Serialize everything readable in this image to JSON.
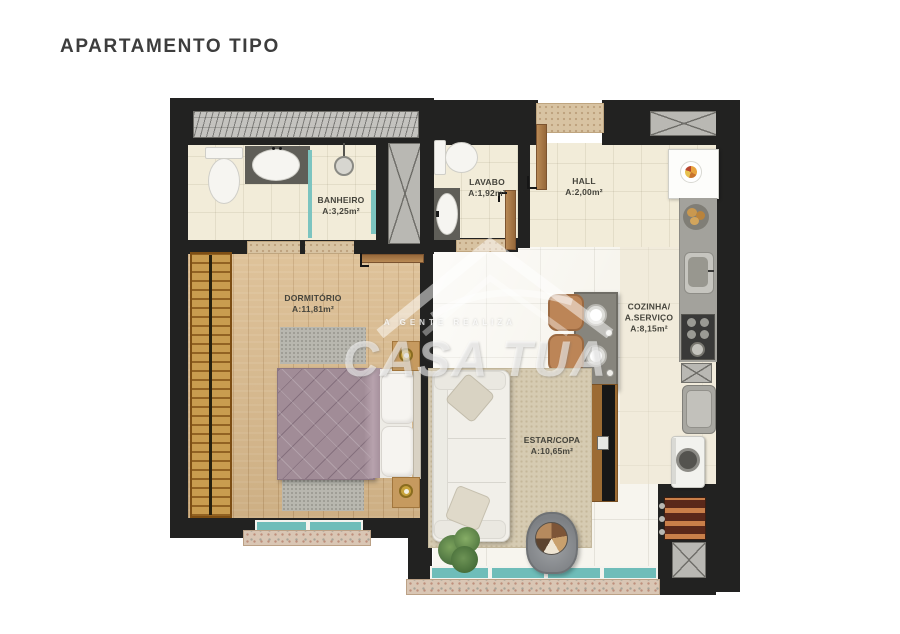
{
  "title": "APARTAMENTO TIPO",
  "watermark": {
    "brand": "CASA TUA",
    "tagline": "A GENTE REALIZA"
  },
  "rooms": {
    "banheiro": {
      "name": "BANHEIRO",
      "area": "A:3,25m²"
    },
    "lavabo": {
      "name": "LAVABO",
      "area": "A:1,92m²"
    },
    "hall": {
      "name": "HALL",
      "area": "A:2,00m²"
    },
    "dormitorio": {
      "name": "DORMITÓRIO",
      "area": "A:11,81m²"
    },
    "cozinha": {
      "name_line1": "COZINHA/",
      "name_line2": "A.SERVIÇO",
      "area": "A:8,15m²"
    },
    "estar": {
      "name": "ESTAR/COPA",
      "area": "A:10,65m²"
    }
  },
  "colors": {
    "wall": "#222221",
    "window_glass": "#6fbdb9",
    "floor_cream": "#f2ecd9",
    "floor_wood": "#daba8c",
    "floor_tile": "#f7f5ee",
    "threshold_stone": "#d8c3a2",
    "title_text": "#3d3d3d"
  }
}
